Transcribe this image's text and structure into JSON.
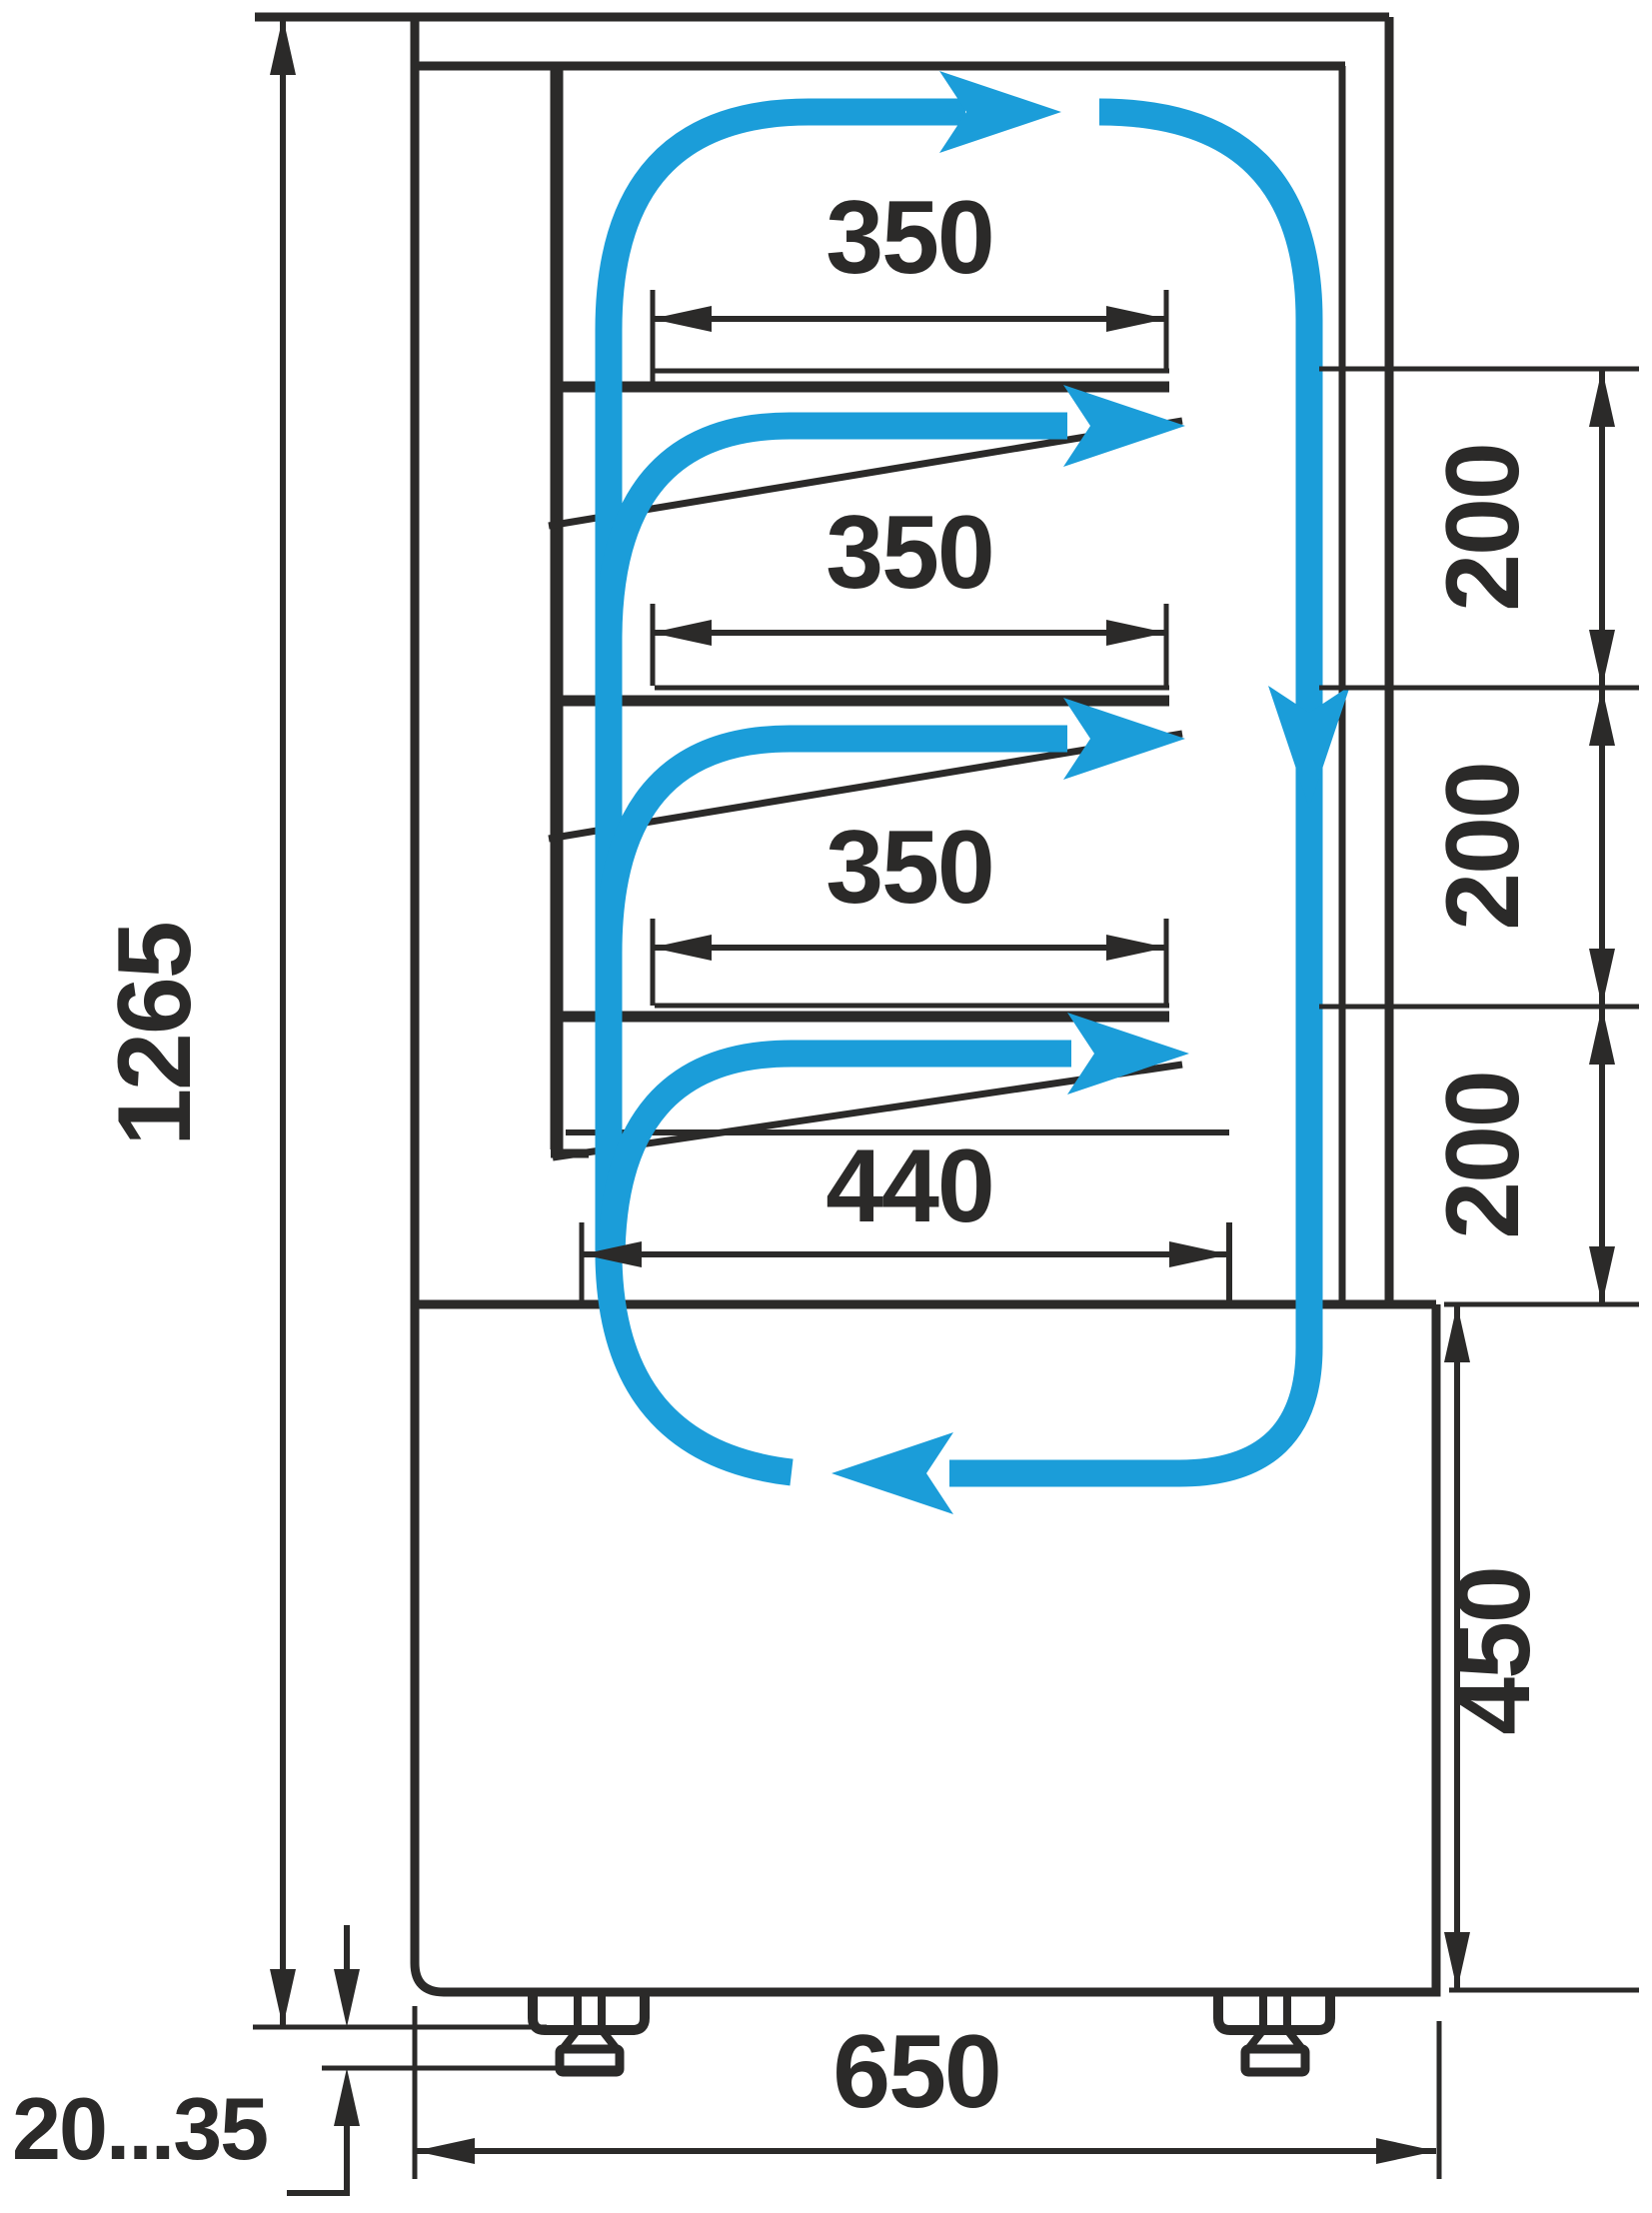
{
  "title": "Refrigerated display case side-section airflow and dimensions diagram",
  "colors": {
    "line": "#2B2A29",
    "flow": "#1B9DD9",
    "background": "#FFFFFF"
  },
  "dimensions": {
    "overall_height": "1265",
    "shelf_depths": [
      "350",
      "350",
      "350"
    ],
    "well_depth": "440",
    "shelf_gaps": [
      "200",
      "200",
      "200"
    ],
    "base_height": "450",
    "overall_depth": "650",
    "foot_adjust_range": "20...35"
  },
  "icons": {
    "airflow_arrows": "blue-airflow-arrow",
    "dimension_arrows": "black-dimension-arrow"
  }
}
